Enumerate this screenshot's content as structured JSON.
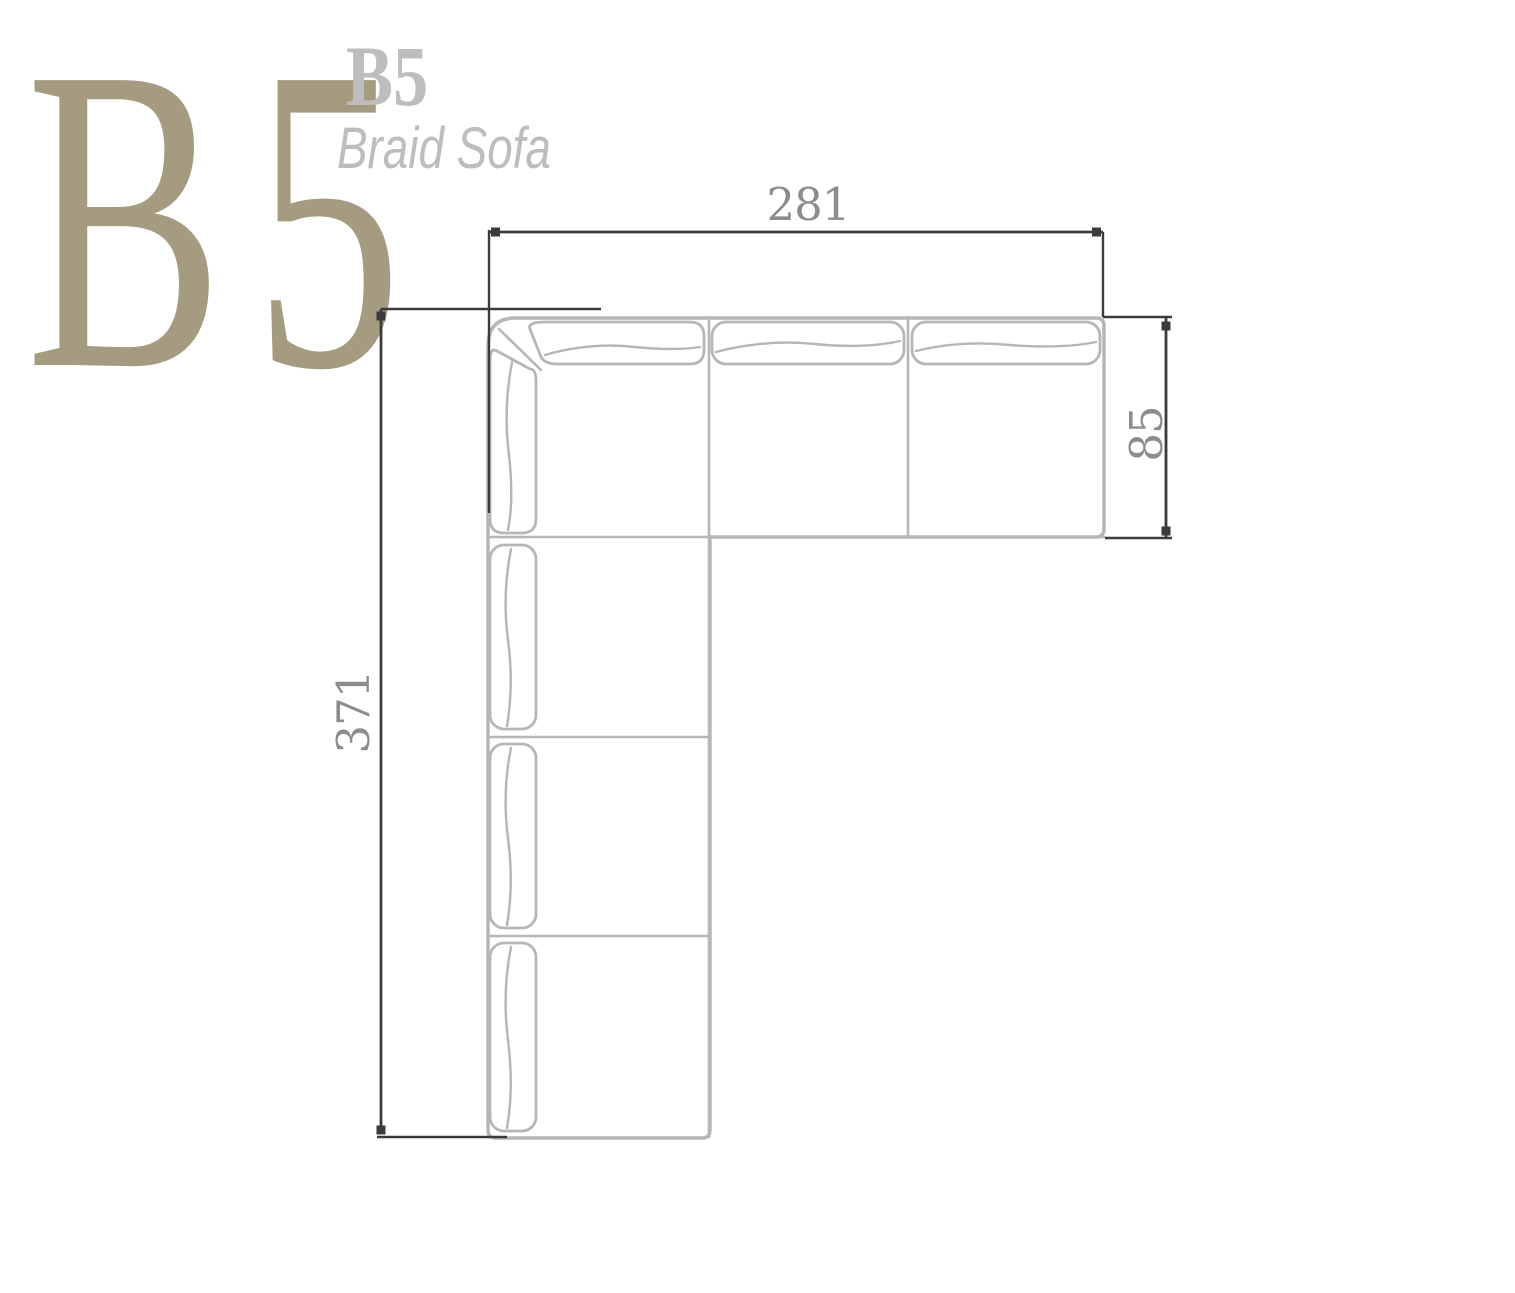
{
  "header": {
    "big_monogram": "B5",
    "model_code": "B5",
    "model_name": "Braid Sofa"
  },
  "dimensions": {
    "width_cm": "281",
    "depth_cm": "85",
    "height_cm": "371"
  },
  "drawing": {
    "view": "top-plan",
    "shape": "L-shaped sectional sofa",
    "top_row_back_cushions": 3,
    "left_column_back_cushions": 4,
    "corner": "mitered top-left corner"
  },
  "colors": {
    "background": "#ffffff",
    "monogram_tan": "#a59b80",
    "header_gray": "#bdbdbd",
    "dimension_text": "#8c8c8c",
    "dimension_line": "#3b3b3b",
    "sofa_outline": "#b6b6b6"
  }
}
